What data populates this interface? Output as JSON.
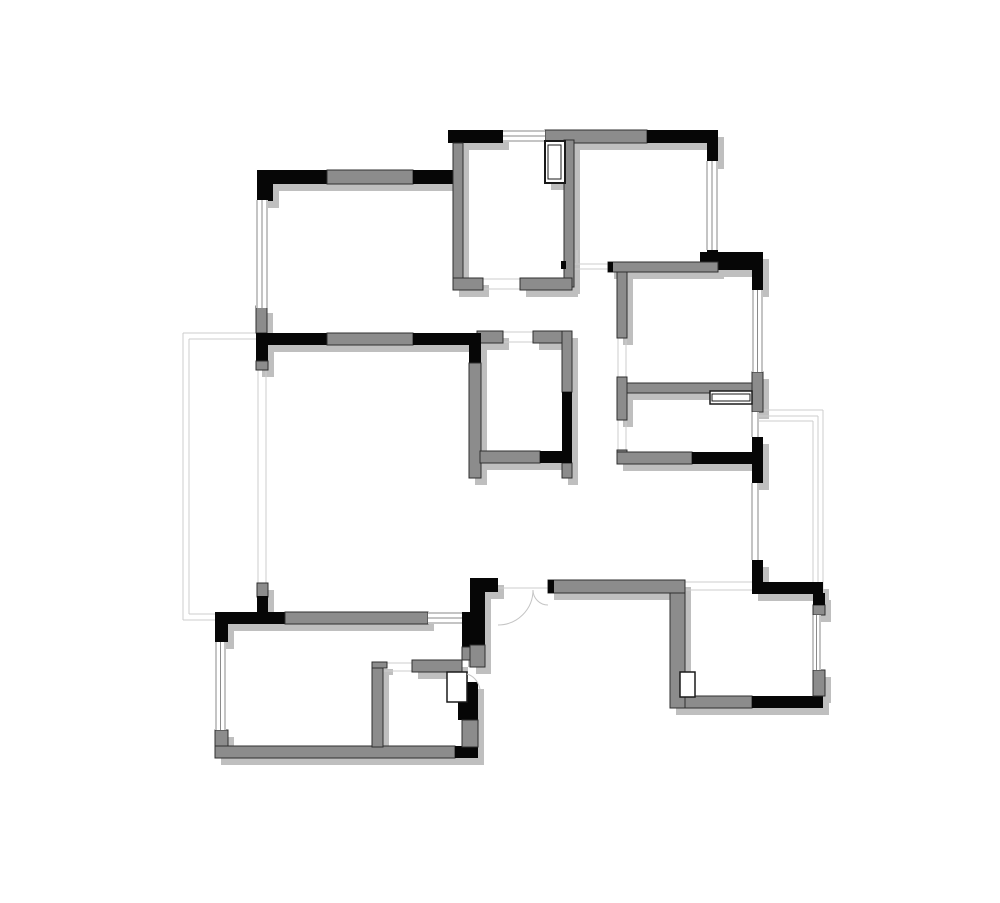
{
  "document": {
    "type": "architectural-floor-plan",
    "description": "black-and-gray wall floor plan with windows, balconies and door swings",
    "canvas": {
      "width": 1000,
      "height": 903,
      "background": "#ffffff"
    }
  },
  "floorplan": {
    "palette": {
      "wall_black": "#060606",
      "wall_gray": "#8c8c8c",
      "wall_outline": "#2f2f2f",
      "shadow": "#bfbfbf",
      "shadow_dx": 6,
      "shadow_dy": 7,
      "window_line": "#8a8a8a",
      "light_line": "#cccccc",
      "arc_line": "#c4c4c4",
      "symbol_stroke": "#1a1a1a",
      "symbol_fill": "#ffffff"
    },
    "walls": [
      [
        257,
        170,
        70,
        14,
        "b"
      ],
      [
        327,
        170,
        86,
        14,
        "g"
      ],
      [
        413,
        170,
        50,
        14,
        "b"
      ],
      [
        257,
        170,
        16,
        31,
        "b"
      ],
      [
        256,
        306,
        11,
        27,
        "g"
      ],
      [
        256,
        333,
        12,
        29,
        "b"
      ],
      [
        256,
        361,
        12,
        9,
        "g"
      ],
      [
        257,
        583,
        11,
        14,
        "g"
      ],
      [
        257,
        596,
        11,
        27,
        "b"
      ],
      [
        448,
        130,
        55,
        13,
        "b"
      ],
      [
        545,
        130,
        102,
        13,
        "g"
      ],
      [
        453,
        143,
        10,
        140,
        "g"
      ],
      [
        564,
        140,
        10,
        147,
        "g"
      ],
      [
        453,
        278,
        30,
        12,
        "g"
      ],
      [
        520,
        278,
        52,
        12,
        "g"
      ],
      [
        561,
        261,
        5,
        8,
        "b"
      ],
      [
        647,
        130,
        71,
        13,
        "b"
      ],
      [
        707,
        130,
        11,
        32,
        "b"
      ],
      [
        707,
        250,
        11,
        20,
        "b"
      ],
      [
        700,
        252,
        63,
        18,
        "b"
      ],
      [
        752,
        252,
        11,
        38,
        "b"
      ],
      [
        608,
        262,
        110,
        10,
        "g"
      ],
      [
        608,
        262,
        5,
        10,
        "b"
      ],
      [
        617,
        272,
        10,
        66,
        "g"
      ],
      [
        617,
        377,
        10,
        43,
        "g"
      ],
      [
        627,
        383,
        136,
        10,
        "g"
      ],
      [
        752,
        372,
        11,
        40,
        "g"
      ],
      [
        752,
        437,
        11,
        46,
        "b"
      ],
      [
        617,
        450,
        10,
        14,
        "g"
      ],
      [
        617,
        452,
        75,
        12,
        "g"
      ],
      [
        692,
        452,
        71,
        12,
        "b"
      ],
      [
        256,
        333,
        71,
        12,
        "b"
      ],
      [
        327,
        333,
        86,
        12,
        "g"
      ],
      [
        413,
        333,
        64,
        12,
        "b"
      ],
      [
        477,
        331,
        26,
        12,
        "g"
      ],
      [
        533,
        331,
        30,
        12,
        "g"
      ],
      [
        469,
        333,
        12,
        30,
        "b"
      ],
      [
        469,
        363,
        12,
        115,
        "g"
      ],
      [
        562,
        331,
        10,
        61,
        "g"
      ],
      [
        562,
        392,
        10,
        71,
        "b"
      ],
      [
        562,
        463,
        10,
        15,
        "g"
      ],
      [
        480,
        451,
        60,
        12,
        "g"
      ],
      [
        540,
        451,
        32,
        12,
        "b"
      ],
      [
        470,
        578,
        28,
        14,
        "b"
      ],
      [
        470,
        578,
        15,
        67,
        "b"
      ],
      [
        462,
        612,
        16,
        35,
        "b"
      ],
      [
        462,
        647,
        16,
        13,
        "g"
      ],
      [
        470,
        645,
        15,
        22,
        "g"
      ],
      [
        548,
        580,
        137,
        13,
        "g"
      ],
      [
        548,
        580,
        6,
        13,
        "b"
      ],
      [
        670,
        593,
        15,
        115,
        "g"
      ],
      [
        685,
        696,
        67,
        12,
        "g"
      ],
      [
        752,
        696,
        71,
        12,
        "b"
      ],
      [
        813,
        670,
        12,
        26,
        "g"
      ],
      [
        813,
        605,
        12,
        10,
        "g"
      ],
      [
        813,
        593,
        12,
        12,
        "b"
      ],
      [
        752,
        582,
        71,
        12,
        "b"
      ],
      [
        752,
        560,
        11,
        34,
        "b"
      ],
      [
        215,
        612,
        13,
        30,
        "b"
      ],
      [
        215,
        612,
        70,
        12,
        "b"
      ],
      [
        285,
        612,
        143,
        12,
        "g"
      ],
      [
        215,
        730,
        13,
        28,
        "g"
      ],
      [
        215,
        746,
        240,
        12,
        "g"
      ],
      [
        455,
        746,
        23,
        12,
        "b"
      ],
      [
        458,
        682,
        20,
        38,
        "b"
      ],
      [
        462,
        720,
        16,
        27,
        "g"
      ],
      [
        412,
        660,
        50,
        12,
        "g"
      ],
      [
        372,
        662,
        11,
        85,
        "g"
      ],
      [
        372,
        662,
        15,
        6,
        "g"
      ]
    ],
    "windows": [
      {
        "x": 257,
        "y": 200,
        "w": 10,
        "h": 108,
        "dir": "v",
        "lines": 3
      },
      {
        "x": 428,
        "y": 613,
        "w": 34,
        "h": 10,
        "dir": "h",
        "lines": 3
      },
      {
        "x": 216,
        "y": 642,
        "w": 9,
        "h": 88,
        "dir": "v",
        "lines": 3
      },
      {
        "x": 503,
        "y": 131,
        "w": 42,
        "h": 10,
        "dir": "h",
        "lines": 3
      },
      {
        "x": 707,
        "y": 161,
        "w": 10,
        "h": 89,
        "dir": "v",
        "lines": 3
      },
      {
        "x": 753,
        "y": 290,
        "w": 9,
        "h": 82,
        "dir": "v",
        "lines": 3
      },
      {
        "x": 752,
        "y": 412,
        "w": 6,
        "h": 25,
        "dir": "v",
        "lines": 2
      },
      {
        "x": 752,
        "y": 483,
        "w": 6,
        "h": 77,
        "dir": "v",
        "lines": 2
      },
      {
        "x": 813,
        "y": 615,
        "w": 7,
        "h": 55,
        "dir": "v",
        "lines": 3
      }
    ],
    "light_lines": [
      [
        183,
        333,
        257,
        333
      ],
      [
        189,
        339,
        257,
        339
      ],
      [
        183,
        333,
        183,
        620
      ],
      [
        189,
        339,
        189,
        614
      ],
      [
        183,
        620,
        215,
        620
      ],
      [
        189,
        614,
        215,
        614
      ],
      [
        758,
        410,
        823,
        410
      ],
      [
        758,
        416,
        818,
        416
      ],
      [
        758,
        421,
        813,
        421
      ],
      [
        823,
        410,
        823,
        594
      ],
      [
        818,
        416,
        818,
        594
      ],
      [
        813,
        421,
        813,
        594
      ],
      [
        258,
        370,
        258,
        583
      ],
      [
        266,
        370,
        266,
        583
      ],
      [
        503,
        332,
        533,
        332
      ],
      [
        503,
        342,
        533,
        342
      ],
      [
        483,
        279,
        520,
        279
      ],
      [
        483,
        289,
        520,
        289
      ],
      [
        573,
        264,
        608,
        264
      ],
      [
        573,
        269,
        608,
        269
      ],
      [
        618,
        338,
        618,
        377
      ],
      [
        626,
        338,
        626,
        377
      ],
      [
        618,
        420,
        618,
        450
      ],
      [
        626,
        420,
        626,
        450
      ],
      [
        685,
        582,
        752,
        582
      ],
      [
        685,
        590,
        752,
        590
      ],
      [
        498,
        588,
        548,
        588
      ],
      [
        573,
        250,
        573,
        263
      ],
      [
        577,
        250,
        577,
        263
      ],
      [
        383,
        663,
        412,
        663
      ],
      [
        383,
        671,
        412,
        671
      ]
    ],
    "symbols": [
      {
        "rect": [
          545,
          141,
          20,
          42
        ],
        "stroke": 2
      },
      {
        "rect": [
          548,
          145,
          13,
          34
        ],
        "stroke": 1
      },
      {
        "rect": [
          710,
          391,
          42,
          13
        ],
        "stroke": 1.5
      },
      {
        "rect": [
          712,
          394,
          38,
          7
        ],
        "stroke": 1
      },
      {
        "rect": [
          447,
          672,
          20,
          30
        ],
        "stroke": 1.5
      },
      {
        "rect": [
          680,
          672,
          15,
          25
        ],
        "stroke": 1.5
      }
    ],
    "arcs": [
      {
        "d": "M533,590 A35,35 0 0 1 498,625"
      },
      {
        "d": "M533,590 A15,15 0 0 0 548,605"
      },
      {
        "d": "M467,674 Q477,677 480,689"
      }
    ]
  }
}
